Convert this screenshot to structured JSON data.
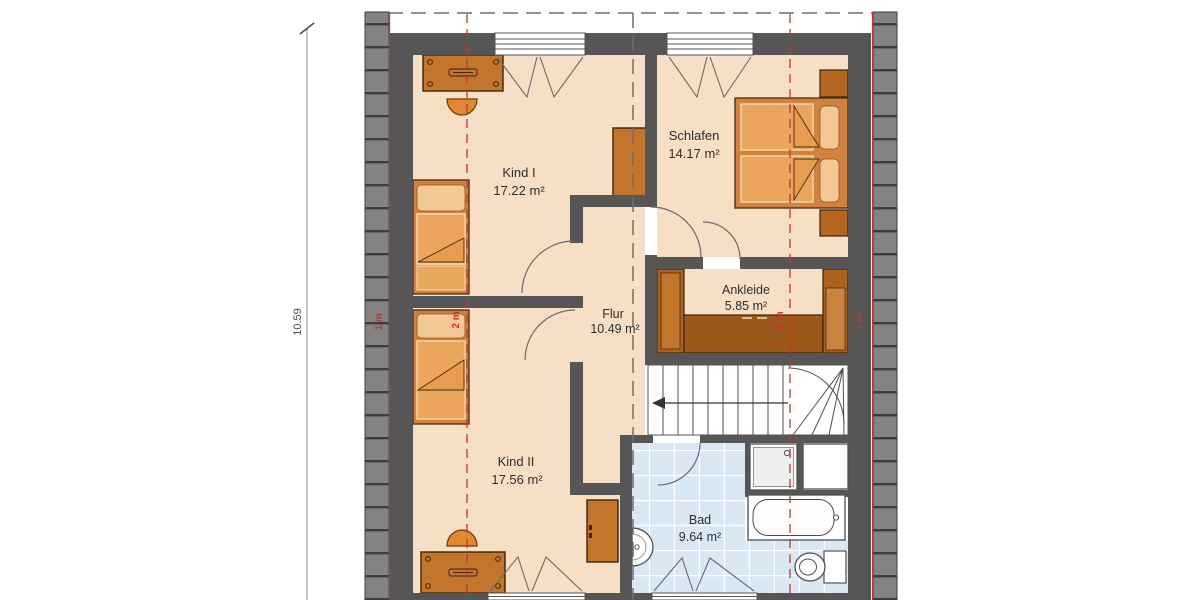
{
  "floorplan": {
    "dimension": {
      "height_label": "10.59"
    },
    "rooms": {
      "kind1": {
        "name": "Kind I",
        "area": "17.22 m²"
      },
      "schlafen": {
        "name": "Schlafen",
        "area": "14.17 m²"
      },
      "ankleide": {
        "name": "Ankleide",
        "area": "5.85 m²"
      },
      "flur": {
        "name": "Flur",
        "area": "10.49 m²"
      },
      "kind2": {
        "name": "Kind II",
        "area": "17.56 m²"
      },
      "bad": {
        "name": "Bad",
        "area": "9.64 m²"
      }
    },
    "height_markers": {
      "left_eave": "1 m",
      "left_2m": "2 m",
      "right_2m": "2 m",
      "right_eave": "1 m"
    },
    "colors": {
      "wall": "#565656",
      "floor": "#f7dfc6",
      "tile": "#d9e8f4",
      "furniture": "#d1823f",
      "furniture_dark": "#c4752c",
      "marker_red": "#c63531",
      "hatch": "#838383"
    }
  }
}
